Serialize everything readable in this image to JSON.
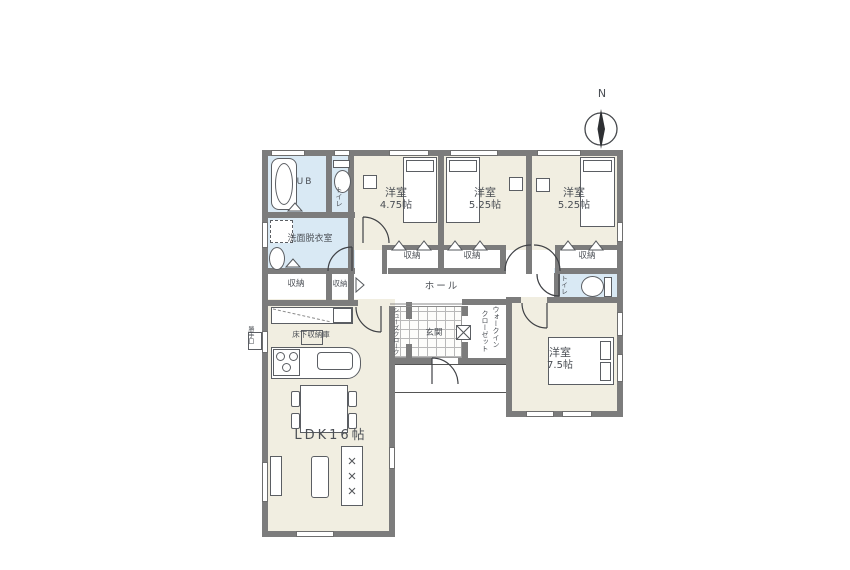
{
  "colors": {
    "wall": "#7c7c7c",
    "room_floor": "#f1eee1",
    "wet_floor": "#d9e9f4",
    "line": "#4b4f55"
  },
  "compass": {
    "north_label": "N"
  },
  "rooms": {
    "ub": {
      "label": "UB"
    },
    "toilet_upper": {
      "label": "トイレ"
    },
    "washroom": {
      "label": "洗面脱衣室"
    },
    "bedroom1": {
      "name": "洋室",
      "size": "4.75帖"
    },
    "bedroom2": {
      "name": "洋室",
      "size": "5.25帖"
    },
    "bedroom3": {
      "name": "洋室",
      "size": "5.25帖"
    },
    "bedroom4": {
      "name": "洋室",
      "size": "7.5帖"
    },
    "ldk": {
      "label": "LDK16帖"
    },
    "hall": {
      "label": "ホール"
    },
    "entrance": {
      "label": "玄関"
    },
    "shoes_closet": {
      "label": "シューズクローク"
    },
    "walk_in_closet": {
      "line1": "ウォークイン",
      "line2": "クローゼット"
    },
    "toilet_lower": {
      "label": "トイレ"
    }
  },
  "closets": {
    "corridor_left": "収納",
    "corridor_right": "収納",
    "bedroom1": "収納",
    "bedroom2": "収納",
    "bedroom3": "収納"
  },
  "annotations": {
    "underfloor_storage": "床下収納庫",
    "back_door": "勝手口"
  }
}
